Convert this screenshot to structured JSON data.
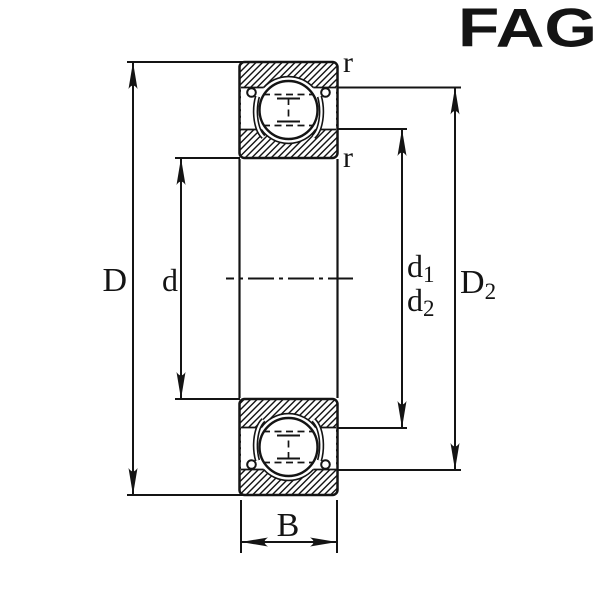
{
  "page": {
    "background": "#ffffff",
    "ink_color": "#141414"
  },
  "logo": {
    "text": "FAG",
    "color": "#DC1733"
  },
  "figure": {
    "labels": {
      "D": "D",
      "d": "d",
      "d1_base": "d",
      "d1_sub": "1",
      "d2_base": "d",
      "d2_sub": "2",
      "D2_base": "D",
      "D2_sub": "2",
      "B": "B",
      "r_top": "r",
      "r_bottom": "r"
    }
  }
}
